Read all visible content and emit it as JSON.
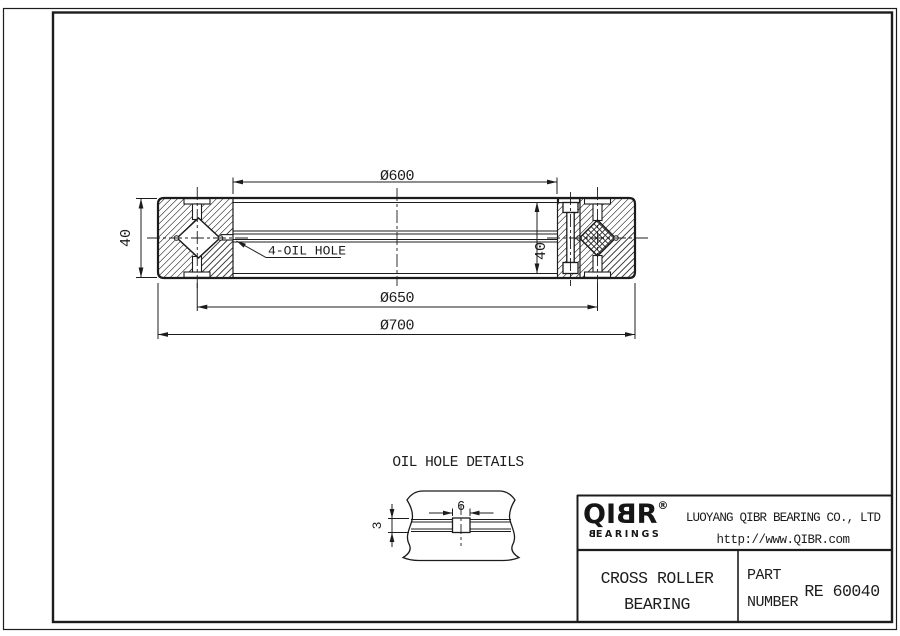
{
  "main_drawing": {
    "dim_bore": "Ø600",
    "dim_pitch": "Ø650",
    "dim_od": "Ø700",
    "dim_width_left": "40",
    "dim_width_right": "40",
    "oil_hole_label": "4-OIL HOLE"
  },
  "oil_hole_detail": {
    "title": "OIL HOLE DETAILS",
    "dim_hole_width": "6",
    "dim_hole_depth": "3"
  },
  "title_block": {
    "logo_brand_prefix": "QI",
    "logo_brand_b": "B",
    "logo_brand_suffix": "R",
    "logo_registered": "®",
    "logo_sub_b": "B",
    "logo_sub_rest": "EARINGS",
    "company": "LUOYANG QIBR BEARING CO., LTD",
    "website": "http://www.QIBR.com",
    "product_name_line1": "CROSS ROLLER",
    "product_name_line2": "BEARING",
    "part_label_line1": "PART",
    "part_label_line2": "NUMBER",
    "part_number": "RE 60040"
  }
}
